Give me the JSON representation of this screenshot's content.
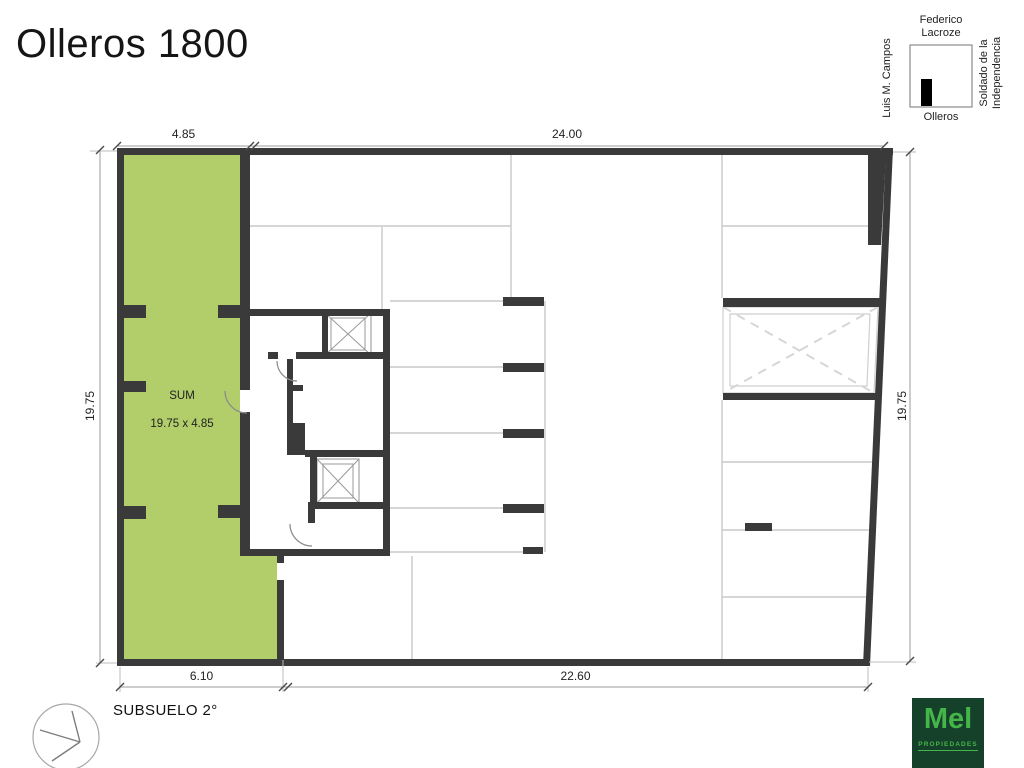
{
  "header": {
    "title": "Olleros 1800"
  },
  "plan": {
    "level_label": "SUBSUELO 2°",
    "room": {
      "name": "SUM",
      "dimensions": "19.75 x 4.85"
    },
    "dims": {
      "top_left": "4.85",
      "top": "24.00",
      "left": "19.75",
      "right": "19.75",
      "bottom_left": "6.10",
      "bottom": "22.60"
    }
  },
  "location_map": {
    "street_top": "Federico Lacroze",
    "street_left": "Luis M. Campos",
    "street_right": "Soldado de la Independencia",
    "street_bottom": "Olleros"
  },
  "logo": {
    "brand": "Mel",
    "tagline": "PROPIEDADES"
  },
  "colors": {
    "room_green": "#b2ce6b",
    "wall": "#3a3a3a",
    "logo_bg": "#15402a",
    "logo_green": "#46b549"
  }
}
